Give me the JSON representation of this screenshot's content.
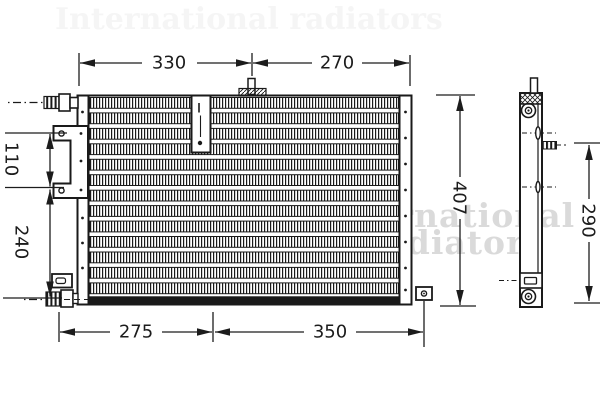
{
  "drawing": {
    "kind": "condenser-technical-drawing",
    "dimensions": {
      "top_left_width": "330",
      "top_right_width": "270",
      "left_upper_height": "110",
      "left_lower_height": "240",
      "front_total_height": "407",
      "bottom_left_width": "275",
      "bottom_right_width": "350",
      "side_view_height": "290"
    },
    "watermark": {
      "line1": "International",
      "line2": "radiators",
      "faint_top": "International radiators"
    },
    "colors": {
      "ink": "#1a1a1a",
      "watermark_gray": "#c3c3c3",
      "background": "#ffffff"
    }
  }
}
